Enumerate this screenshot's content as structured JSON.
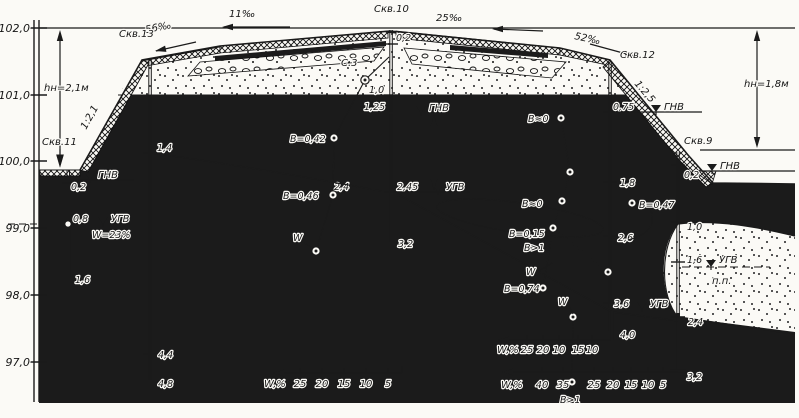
{
  "drawing": {
    "axis": [
      "102,0",
      "101,0",
      "100,0",
      "99,0",
      "98,0",
      "97,0"
    ],
    "boreholes": {
      "skv13": "Скв.13",
      "skv10": "Скв.10",
      "skv11": "Скв.11",
      "skv12": "Скв.12",
      "skv9": "Скв.9"
    },
    "grades": {
      "g56": "56‰",
      "g11": "11‰",
      "g25": "25‰",
      "g52": "52‰",
      "left_slope": "1:2,1",
      "right_slope": "1:2,5"
    },
    "heights": {
      "left": "hн=2,1м",
      "right": "hн=1,8м"
    },
    "water": {
      "gnv": "ГНВ",
      "ugv": "УГВ"
    },
    "depths": {
      "skv11": {
        "d1": "0,2",
        "d2": "0,8",
        "d3": "1,6"
      },
      "skv13": {
        "d1": "1,4",
        "d2": "4,4",
        "d3": "4,8"
      },
      "skv10": {
        "d1": "0,2",
        "d2": "1,0",
        "d3": "1,25",
        "d4": "2,4",
        "d5": "2,45",
        "d6": "3,2"
      },
      "skv12": {
        "d1": "0,75",
        "d2": "1,8",
        "d3": "2,6",
        "d4": "3,6",
        "d5": "4,0"
      },
      "skv9": {
        "d1": "0,2",
        "d2": "1,0",
        "d3": "1,6",
        "d4": "2,4",
        "d5": "3,2"
      }
    },
    "samples": {
      "c3": "С.3",
      "b042": "В=0,42",
      "b046": "В=0,46",
      "b0_top": "В≈0",
      "b0_mid": "В≈0",
      "b015": "В=0,15",
      "bgt1_mid": "В>1",
      "b074": "В=0,74",
      "b047": "В=0,47",
      "bgt1_bottom": "В>1",
      "w": "W",
      "w23": "W=23%",
      "pp": "п.п."
    },
    "scales": {
      "a": {
        "label": "W,%",
        "ticks": [
          "25",
          "20",
          "15",
          "10",
          "5"
        ]
      },
      "b": {
        "label": "W,%",
        "ticks": [
          "25",
          "20",
          "10",
          "15",
          "10"
        ]
      },
      "c": {
        "label": "W,%",
        "ticks": [
          "40",
          "35",
          "25",
          "20",
          "15",
          "10",
          "5"
        ]
      }
    }
  }
}
